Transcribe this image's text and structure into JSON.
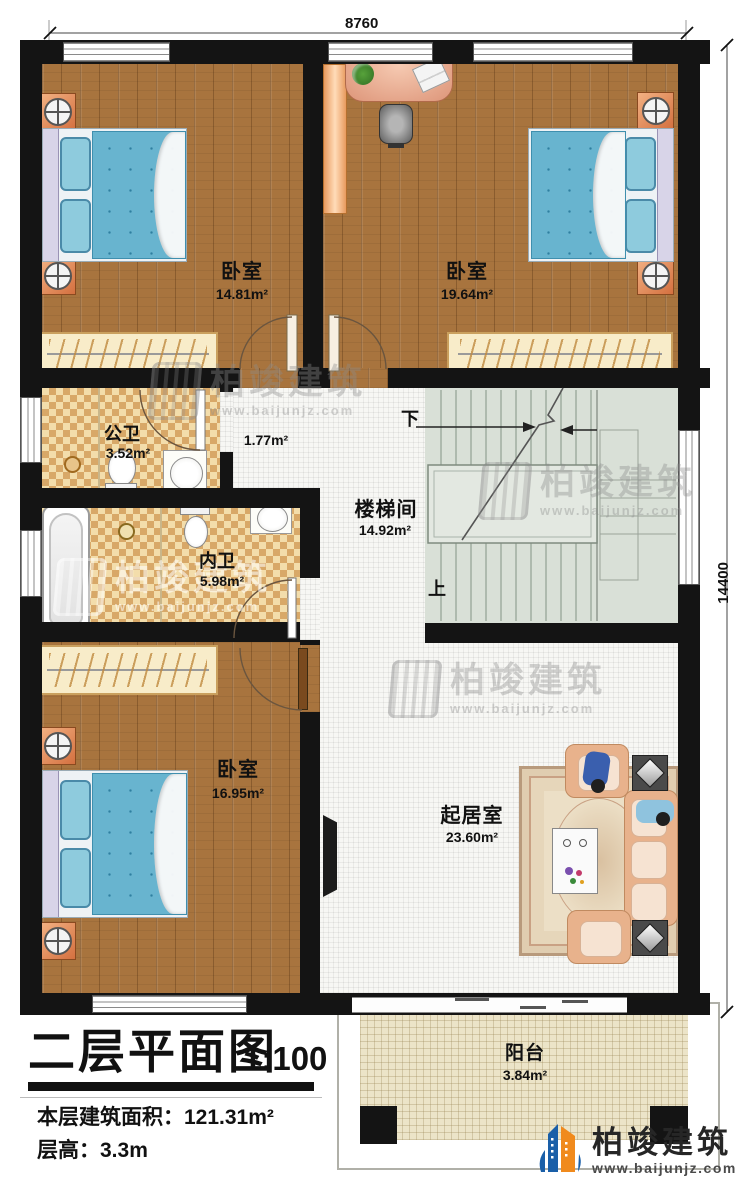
{
  "dimensions": {
    "top": "8760",
    "right": "14400"
  },
  "rooms": {
    "bedroom1": {
      "name": "卧室",
      "area": "14.81m²"
    },
    "bedroom2": {
      "name": "卧室",
      "area": "19.64m²"
    },
    "hall": {
      "area": "1.77m²"
    },
    "public_bath": {
      "name": "公卫",
      "area": "3.52m²"
    },
    "inner_bath": {
      "name": "内卫",
      "area": "5.98m²"
    },
    "stairwell": {
      "name": "楼梯间",
      "area": "14.92m²"
    },
    "bedroom3": {
      "name": "卧室",
      "area": "16.95m²"
    },
    "living_room": {
      "name": "起居室",
      "area": "23.60m²"
    },
    "balcony": {
      "name": "阳台",
      "area": "3.84m²"
    }
  },
  "stairs": {
    "down_label": "下",
    "up_label": "上"
  },
  "title_block": {
    "title": "二层平面图",
    "scale": "1:100",
    "floor_area_line": "本层建筑面积：121.31m²",
    "floor_height_line": "层高：3.3m"
  },
  "brand": {
    "name": "柏竣建筑",
    "website": "www.baijunjz.com"
  },
  "watermark": {
    "name": "柏竣建筑",
    "website": "www.baijunjz.com"
  },
  "colors": {
    "wall": "#141414",
    "wood": "#a8743e",
    "checker_dark": "#d8a868",
    "stair": "#d9e0d7",
    "balcony": "#ece4c8",
    "brand_blue": "#1a5fa8",
    "brand_orange": "#f08a1d"
  }
}
